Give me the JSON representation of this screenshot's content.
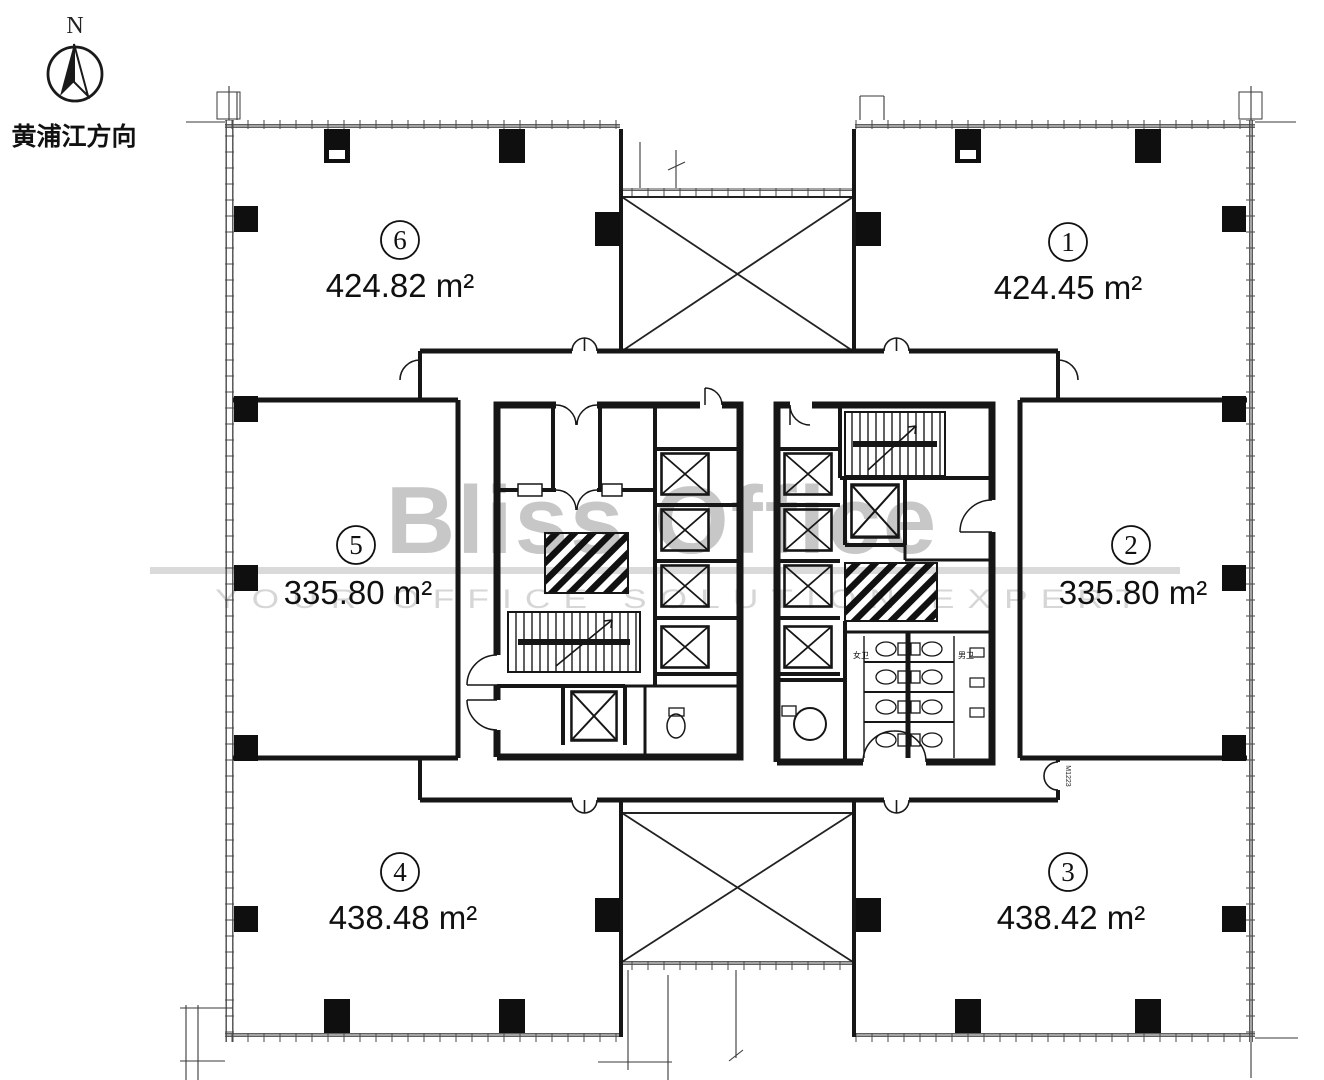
{
  "page": {
    "background": "#ffffff"
  },
  "compass": {
    "north_label": "N",
    "direction_label": "黄浦江方向"
  },
  "watermark": {
    "brand": "Bliss Office",
    "tagline": "YOUR OFFICE SOLUTION EXPERT",
    "brand_color": "#c7c7c7",
    "line_color": "#dadada"
  },
  "plan": {
    "type": "office-floor-plan",
    "units": [
      {
        "id": "unit-1",
        "num": "1",
        "area": "424.45 m²",
        "position": "top-right"
      },
      {
        "id": "unit-2",
        "num": "2",
        "area": "335.80 m²",
        "position": "middle-right"
      },
      {
        "id": "unit-3",
        "num": "3",
        "area": "438.42 m²",
        "position": "bottom-right"
      },
      {
        "id": "unit-4",
        "num": "4",
        "area": "438.48 m²",
        "position": "bottom-left"
      },
      {
        "id": "unit-5",
        "num": "5",
        "area": "335.80 m²",
        "position": "middle-left"
      },
      {
        "id": "unit-6",
        "num": "6",
        "area": "424.82 m²",
        "position": "top-left"
      }
    ],
    "core_labels": {
      "womens_wc": "女卫",
      "mens_wc": "男卫",
      "door_tag": "M1223"
    },
    "line_color": "#161616"
  }
}
